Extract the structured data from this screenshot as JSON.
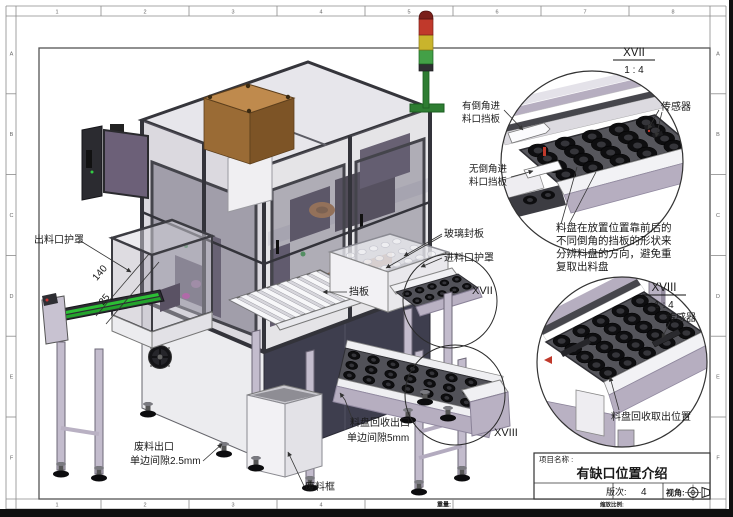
{
  "sheet": {
    "zones_top": [
      "1",
      "2",
      "3",
      "4",
      "5",
      "6",
      "7",
      "8"
    ],
    "zones_bottom": [
      "1",
      "2",
      "3",
      "4"
    ],
    "zones_left": [
      "A",
      "B",
      "C",
      "D",
      "E",
      "F"
    ],
    "zones_right": [
      "A",
      "B",
      "C",
      "D",
      "E",
      "F"
    ],
    "weight_label": "重量:",
    "scale_label": "缩放比例:"
  },
  "title_block": {
    "project_label": "项目名称 :",
    "project_name": "有缺口位置介绍",
    "revision_label": "版次:",
    "revision_value": "4",
    "view_angle_label": "视角:"
  },
  "main_view": {
    "labels": {
      "outlet_cover": "出料口护罩",
      "dim_140": "140",
      "dim_25": "25",
      "glass_panel": "玻璃封板",
      "inlet_cover": "进料口护罩",
      "baffle": "挡板",
      "callout_xvii": "XVII",
      "tray_recycle_outlet_line1": "料盘回收出口",
      "tray_recycle_outlet_line2": "单边间隙5mm",
      "callout_xviii": "XVIII",
      "scrap_outlet_line1": "废料出口",
      "scrap_outlet_line2": "单边间隙2.5mm",
      "scrap_bin": "废料框"
    }
  },
  "detail_xvii": {
    "view_id": "XVII",
    "view_scale": "1 : 4",
    "labels": {
      "chamfered_line1": "有倒角进",
      "chamfered_line2": "料口挡板",
      "sensor": "传感器",
      "plain_line1": "无倒角进",
      "plain_line2": "料口挡板"
    },
    "note_line1": "料盘在放置位置靠前后的",
    "note_line2": "不同倒角的挡板的形状来",
    "note_line3": "分辨料盘的方向，避免重",
    "note_line4": "复取出料盘"
  },
  "detail_xviii": {
    "view_id": "XVIII",
    "view_scale": "1 : 4",
    "labels": {
      "sensor": "传感器",
      "pickup_position": "料盘回收取出位置"
    }
  }
}
